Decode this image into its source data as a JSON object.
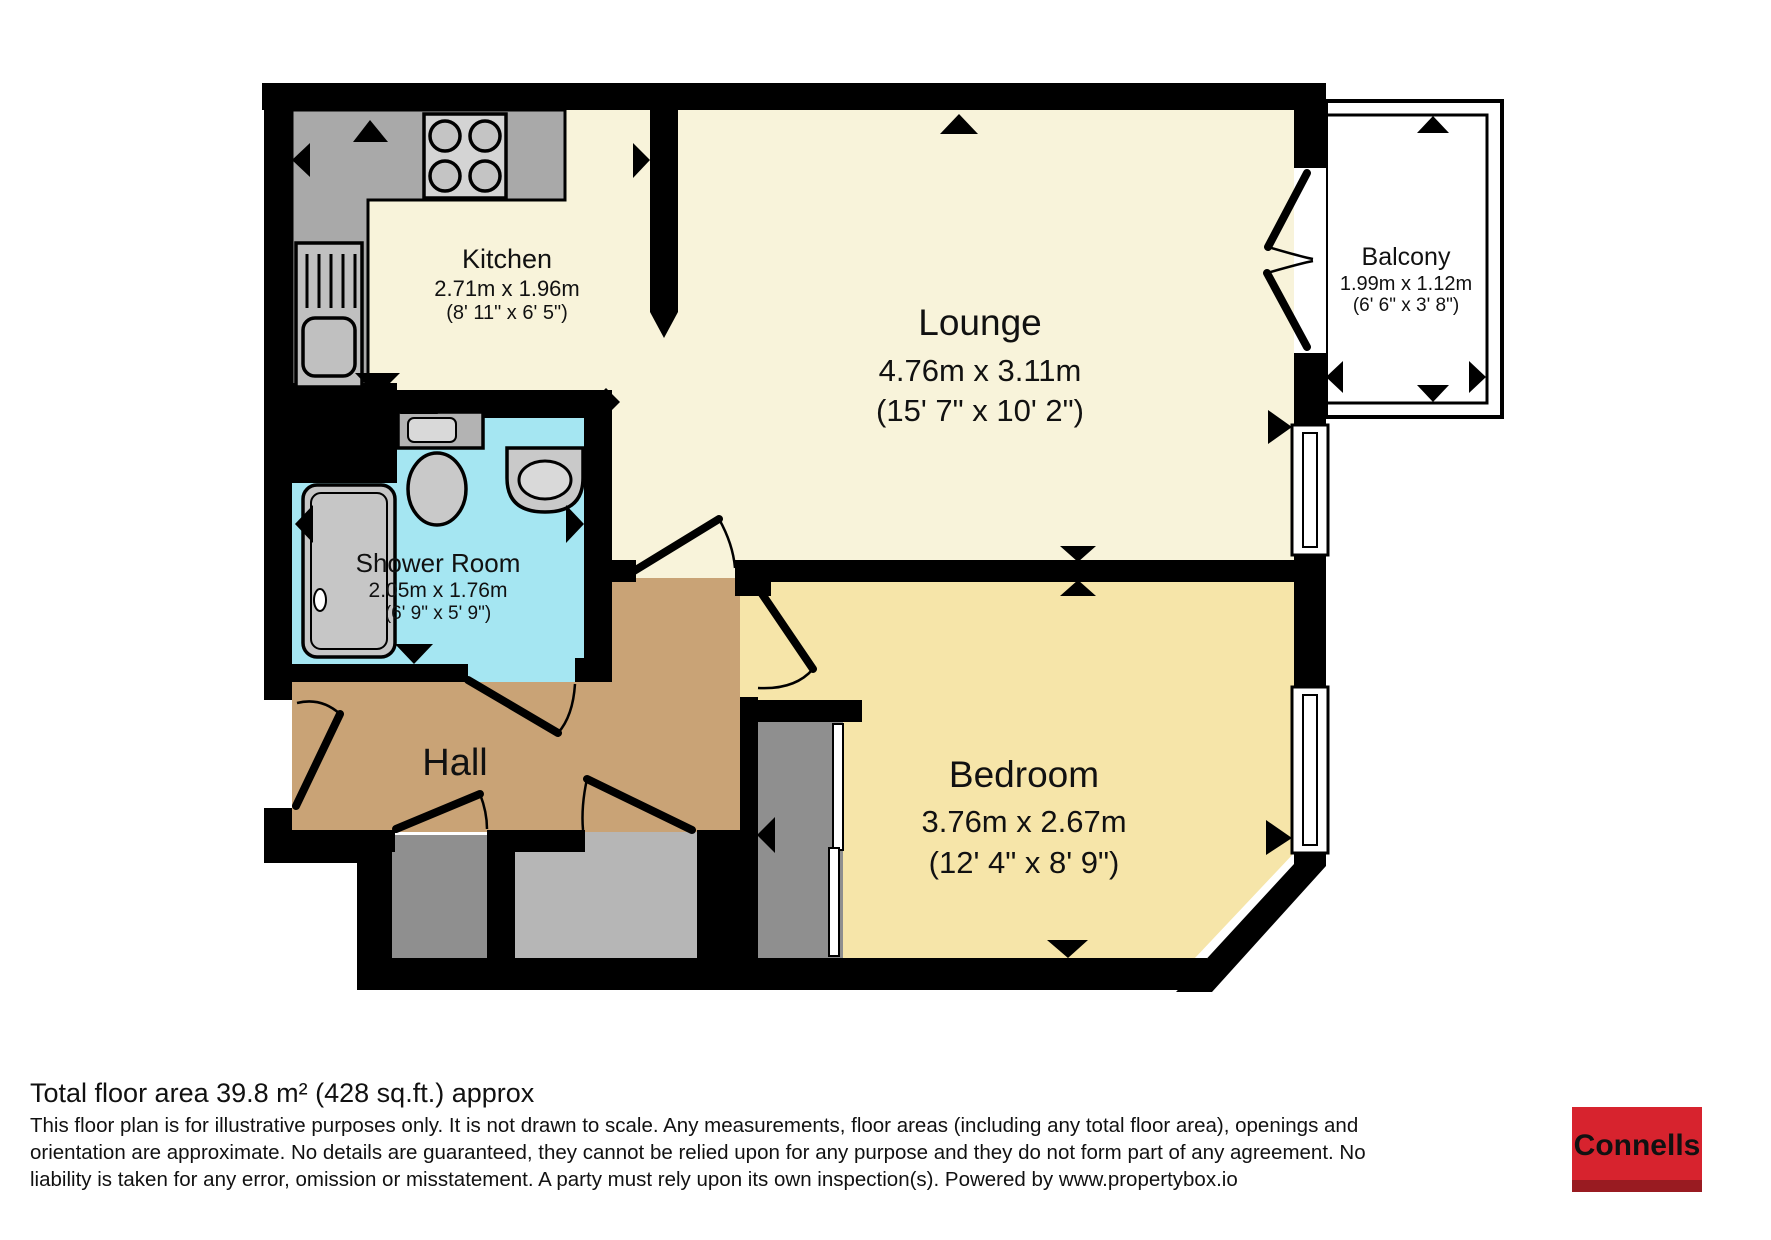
{
  "plan": {
    "colors": {
      "wall": "#000000",
      "lounge_floor": "#f8f3da",
      "bedroom_floor": "#f6e5a9",
      "hall_floor": "#c9a376",
      "shower_floor": "#a5e6f2",
      "counter": "#a9a9a9",
      "cupboard_dark": "#8f8f8f",
      "cupboard_light": "#b6b6b6",
      "fixture": "#c9c9c9",
      "balcony_floor": "#ffffff"
    },
    "rooms": [
      {
        "name": "Kitchen",
        "metric": "2.71m x 1.96m",
        "imperial": "(8' 11\" x 6' 5\")"
      },
      {
        "name": "Lounge",
        "metric": "4.76m x 3.11m",
        "imperial": "(15' 7\" x 10' 2\")"
      },
      {
        "name": "Balcony",
        "metric": "1.99m x 1.12m",
        "imperial": "(6' 6\" x 3' 8\")"
      },
      {
        "name": "Shower Room",
        "metric": "2.05m x 1.76m",
        "imperial": "(6' 9\" x 5' 9\")"
      },
      {
        "name": "Hall"
      },
      {
        "name": "Bedroom",
        "metric": "3.76m x 2.67m",
        "imperial": "(12' 4\" x 8' 9\")"
      }
    ]
  },
  "footer": {
    "total_area": "Total floor area 39.8 m² (428 sq.ft.) approx",
    "disclaimer_lines": [
      "This floor plan is for illustrative purposes only. It is not drawn to scale. Any measurements, floor areas (including any total floor area), openings and",
      "orientation are approximate. No details are guaranteed, they cannot be relied upon for any purpose and they do not form part of any agreement. No",
      "liability is taken for any error, omission or misstatement. A party must rely upon its own inspection(s). Powered by www.propertybox.io"
    ],
    "brand": {
      "label": "Connells",
      "bg": "#d7232e",
      "strip": "#991b21",
      "text_color": "#ffffff"
    }
  }
}
